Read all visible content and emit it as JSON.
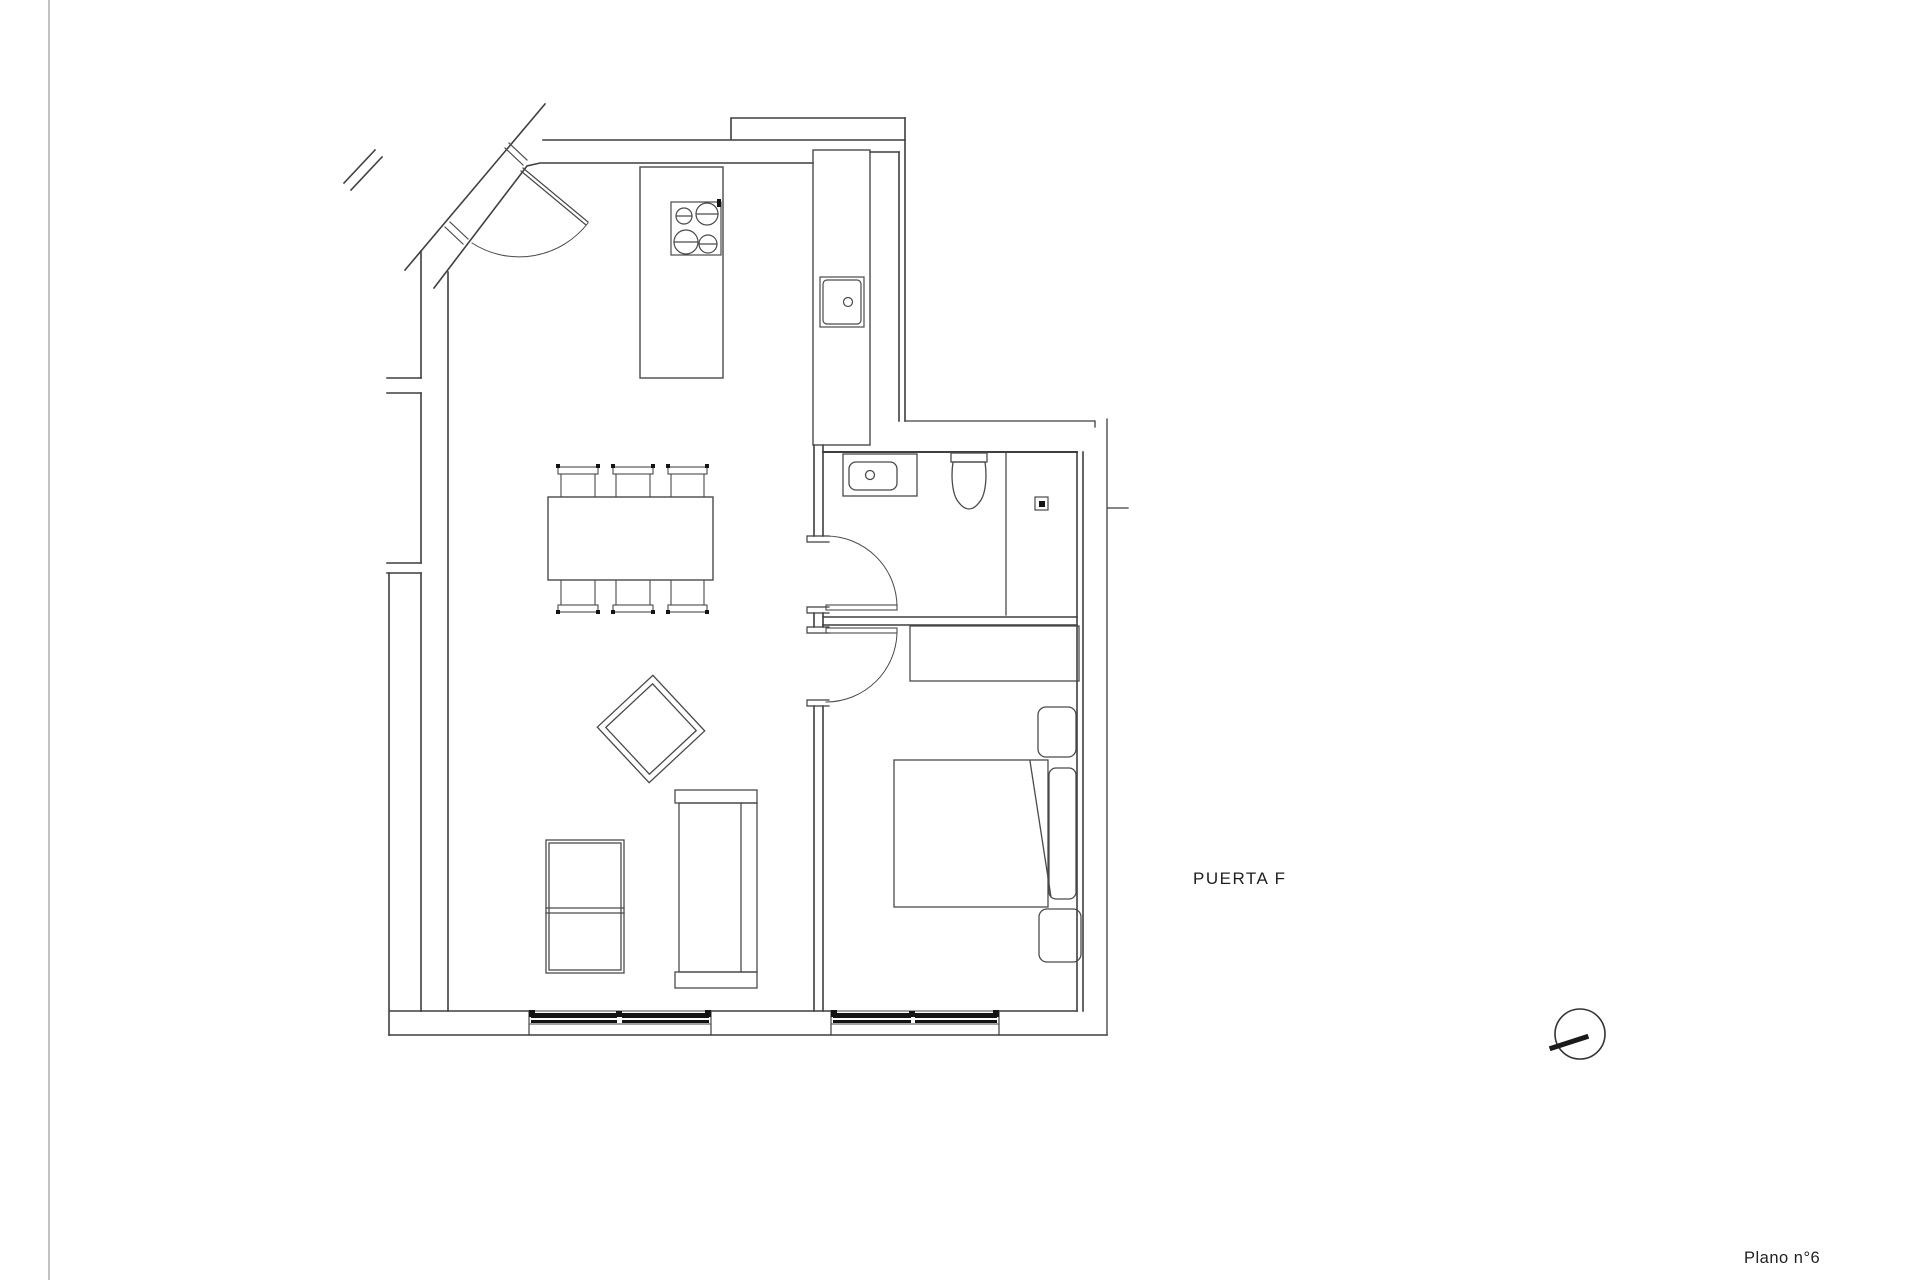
{
  "page": {
    "background": "#ffffff",
    "line_color": "#3f3f3f",
    "dark_fill": "#141414"
  },
  "labels": {
    "door_label": "PUERTA F",
    "sheet_label": "Plano n°6"
  }
}
